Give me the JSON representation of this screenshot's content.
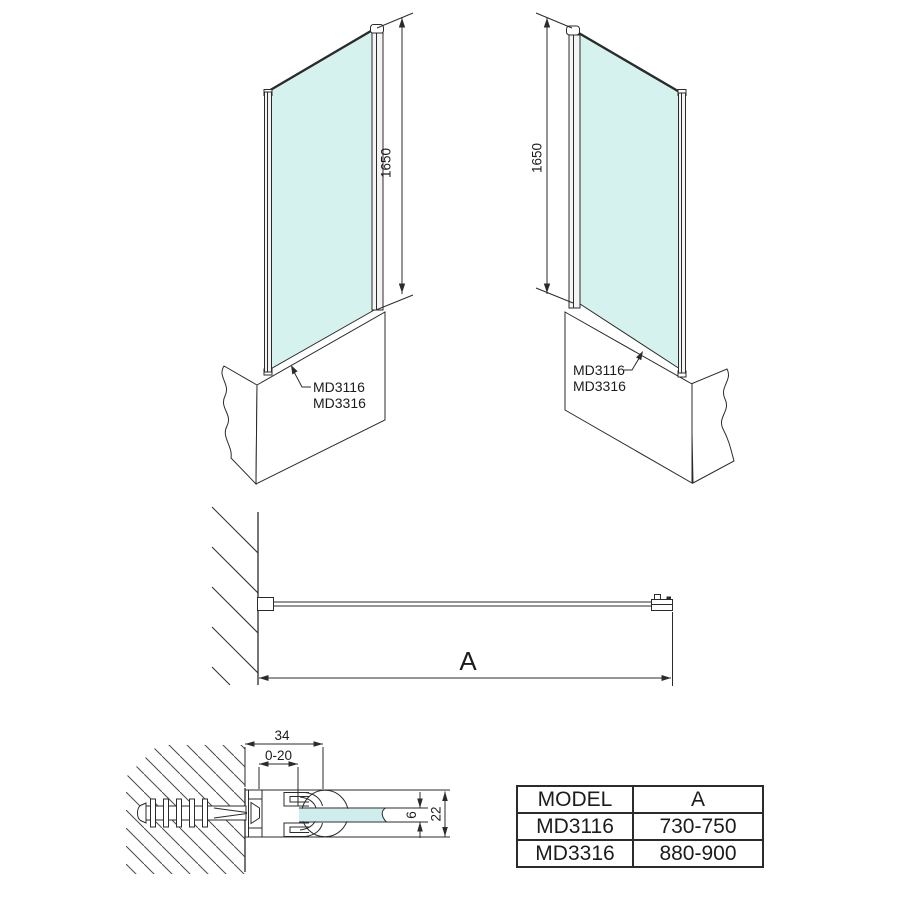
{
  "views": {
    "front_left": {
      "dim_height": "1650",
      "model_labels": [
        "MD3116",
        "MD3316"
      ]
    },
    "front_right": {
      "dim_height": "1650",
      "model_labels": [
        "MD3116",
        "MD3316"
      ]
    },
    "plan": {
      "dim_width": "A"
    },
    "detail": {
      "dim_profile_width": "34",
      "dim_adjustment": "0-20",
      "dim_glass_thickness": "6",
      "dim_profile_height": "22"
    }
  },
  "table": {
    "headers": [
      "MODEL",
      "A"
    ],
    "rows": [
      [
        "MD3116",
        "730-750"
      ],
      [
        "MD3316",
        "880-900"
      ]
    ]
  },
  "colors": {
    "glass_fill": "#d6f2ef",
    "detail_glass_fill": "#cdeeec",
    "line": "#2b2b2b",
    "text": "#1c1c1c"
  }
}
